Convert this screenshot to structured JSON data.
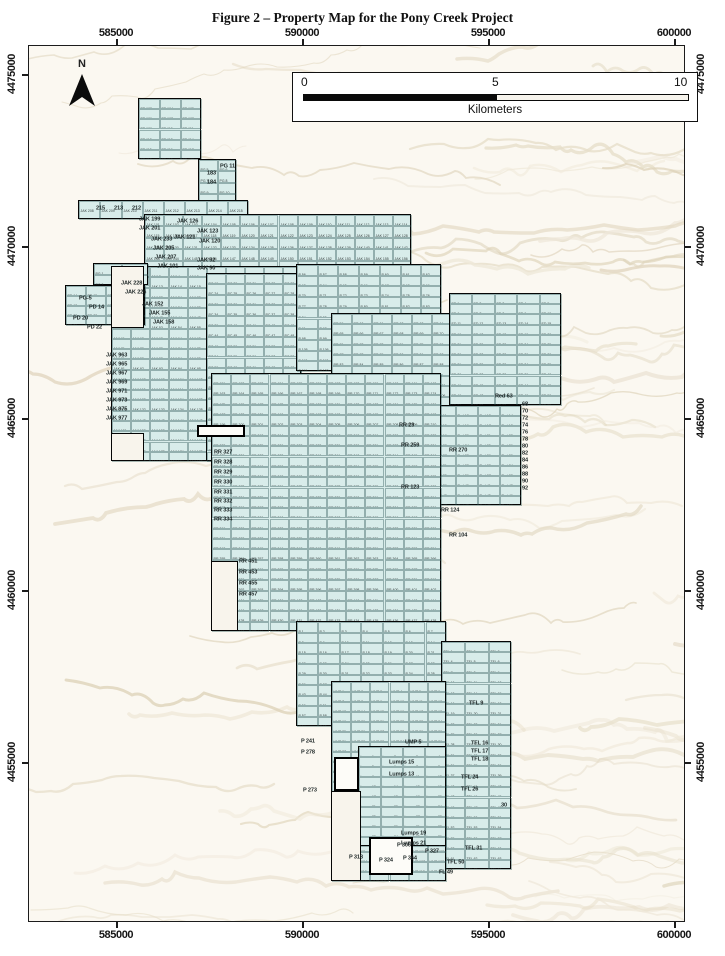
{
  "figure_title": "Figure 2 – Property Map for the Pony Creek Project",
  "north_label": "N",
  "scale_bar": {
    "tick_labels": [
      "0",
      "5",
      "10"
    ],
    "units": "Kilometers"
  },
  "axes": {
    "x_labels": [
      "585000",
      "590000",
      "595000",
      "600000"
    ],
    "x_positions": [
      116,
      302,
      488,
      674
    ],
    "y_labels": [
      "4475000",
      "4470000",
      "4465000",
      "4460000",
      "4455000"
    ],
    "y_positions": [
      74,
      246,
      418,
      590,
      762
    ]
  },
  "colors": {
    "claim_fill": "#d8ecea",
    "claim_outline": "#050505",
    "terrain_base": "#fbf8f1",
    "terrain_ridges": [
      "#e7dfcb",
      "#ddd2b8",
      "#efe8d9",
      "#e2d8c2"
    ]
  },
  "claims": {
    "group_prefixes": [
      "PB",
      "JAK",
      "PC",
      "RR",
      "ED",
      "Red",
      "P",
      "PG",
      "PD",
      "UMP",
      "TFL",
      "Lumps"
    ],
    "blocks": [
      {
        "id": "pb-top",
        "prefix": "PB",
        "start": 103,
        "x": 137,
        "y": 97,
        "w": 63,
        "h": 61
      },
      {
        "id": "pg-neck",
        "prefix": "PG",
        "start": 5,
        "x": 197,
        "y": 158,
        "w": 38,
        "h": 57
      },
      {
        "id": "west-arm",
        "prefix": "JAK",
        "start": 208,
        "x": 77,
        "y": 199,
        "w": 170,
        "h": 19
      },
      {
        "id": "jak-band",
        "prefix": "JAK",
        "start": 101,
        "x": 143,
        "y": 213,
        "w": 267,
        "h": 57
      },
      {
        "id": "jak-main",
        "prefix": "JAK",
        "start": 1,
        "x": 110,
        "y": 265,
        "w": 190,
        "h": 195
      },
      {
        "id": "pc-columns",
        "prefix": "PC",
        "start": 19,
        "x": 205,
        "y": 272,
        "w": 95,
        "h": 188
      },
      {
        "id": "p-upper",
        "prefix": "P",
        "start": 56,
        "x": 295,
        "y": 263,
        "w": 145,
        "h": 107
      },
      {
        "id": "rr-east",
        "prefix": "RR",
        "start": 59,
        "x": 330,
        "y": 312,
        "w": 120,
        "h": 93
      },
      {
        "id": "ed-block",
        "prefix": "ED",
        "start": 1,
        "x": 448,
        "y": 292,
        "w": 112,
        "h": 112
      },
      {
        "id": "red-strip",
        "prefix": "Red",
        "start": 11,
        "x": 432,
        "y": 404,
        "w": 88,
        "h": 100
      },
      {
        "id": "rr-main",
        "prefix": "RR",
        "start": 151,
        "x": 210,
        "y": 372,
        "w": 230,
        "h": 258
      },
      {
        "id": "p-block",
        "prefix": "P",
        "start": 1,
        "x": 295,
        "y": 620,
        "w": 150,
        "h": 105
      },
      {
        "id": "tfl-column",
        "prefix": "TFL",
        "start": 1,
        "x": 440,
        "y": 640,
        "w": 70,
        "h": 228
      },
      {
        "id": "ump-block",
        "prefix": "UMP",
        "start": 1,
        "x": 330,
        "y": 680,
        "w": 115,
        "h": 200
      },
      {
        "id": "lumps-block",
        "prefix": "Lumps",
        "start": 1,
        "x": 357,
        "y": 745,
        "w": 88,
        "h": 100
      },
      {
        "id": "pg-west",
        "prefix": "PG",
        "start": 1,
        "x": 92,
        "y": 262,
        "w": 55,
        "h": 22
      },
      {
        "id": "pd-west",
        "prefix": "PD",
        "start": 14,
        "x": 64,
        "y": 284,
        "w": 80,
        "h": 40
      }
    ],
    "notches": [
      {
        "x": 110,
        "y": 265,
        "w": 33,
        "h": 62
      },
      {
        "x": 110,
        "y": 432,
        "w": 33,
        "h": 28
      },
      {
        "x": 210,
        "y": 560,
        "w": 27,
        "h": 70
      },
      {
        "x": 330,
        "y": 790,
        "w": 30,
        "h": 90
      }
    ],
    "holes": [
      {
        "x": 196,
        "y": 424,
        "w": 48,
        "h": 12
      },
      {
        "x": 333,
        "y": 756,
        "w": 25,
        "h": 34
      },
      {
        "x": 368,
        "y": 836,
        "w": 44,
        "h": 38
      }
    ],
    "annotations": [
      {
        "text": "215",
        "x": 95,
        "y": 203
      },
      {
        "text": "213",
        "x": 113,
        "y": 203
      },
      {
        "text": "212",
        "x": 131,
        "y": 203
      },
      {
        "text": "JAK 199",
        "x": 138,
        "y": 214
      },
      {
        "text": "JAK 201",
        "x": 138,
        "y": 223
      },
      {
        "text": "JAK 233",
        "x": 150,
        "y": 234
      },
      {
        "text": "JAK 205",
        "x": 152,
        "y": 243
      },
      {
        "text": "JAK 207",
        "x": 154,
        "y": 252
      },
      {
        "text": "JAK 101",
        "x": 156,
        "y": 261
      },
      {
        "text": "JAK 126",
        "x": 176,
        "y": 216
      },
      {
        "text": "JAK 123",
        "x": 196,
        "y": 226
      },
      {
        "text": "JAK 121",
        "x": 173,
        "y": 232
      },
      {
        "text": "JAK 120",
        "x": 198,
        "y": 236
      },
      {
        "text": "JAK 92",
        "x": 196,
        "y": 255
      },
      {
        "text": "JAK 90",
        "x": 196,
        "y": 263
      },
      {
        "text": "183",
        "x": 206,
        "y": 168
      },
      {
        "text": "184",
        "x": 206,
        "y": 177
      },
      {
        "text": "PG 11",
        "x": 219,
        "y": 161
      },
      {
        "text": "JAK 228",
        "x": 120,
        "y": 278
      },
      {
        "text": "JAK 226",
        "x": 124,
        "y": 287
      },
      {
        "text": "JAK 152",
        "x": 141,
        "y": 299
      },
      {
        "text": "JAK 155",
        "x": 148,
        "y": 308
      },
      {
        "text": "JAK 158",
        "x": 152,
        "y": 317
      },
      {
        "text": "PG-5",
        "x": 78,
        "y": 293
      },
      {
        "text": "PD 14",
        "x": 88,
        "y": 302
      },
      {
        "text": "PD 20",
        "x": 72,
        "y": 313
      },
      {
        "text": "PD 22",
        "x": 86,
        "y": 322
      },
      {
        "text": "JAK 963",
        "x": 105,
        "y": 350
      },
      {
        "text": "JAK 965",
        "x": 105,
        "y": 359
      },
      {
        "text": "JAK 967",
        "x": 105,
        "y": 368
      },
      {
        "text": "JAK 969",
        "x": 105,
        "y": 377
      },
      {
        "text": "JAK 971",
        "x": 105,
        "y": 386
      },
      {
        "text": "JAK 973",
        "x": 105,
        "y": 395
      },
      {
        "text": "JAK 975",
        "x": 105,
        "y": 404
      },
      {
        "text": "JAK 977",
        "x": 105,
        "y": 413
      },
      {
        "text": "RR 327",
        "x": 213,
        "y": 447
      },
      {
        "text": "RR 328",
        "x": 213,
        "y": 457
      },
      {
        "text": "RR 329",
        "x": 213,
        "y": 467
      },
      {
        "text": "RR 330",
        "x": 213,
        "y": 477
      },
      {
        "text": "RR 331",
        "x": 213,
        "y": 487
      },
      {
        "text": "RR 332",
        "x": 213,
        "y": 496
      },
      {
        "text": "RR 333",
        "x": 213,
        "y": 505
      },
      {
        "text": "RR 334",
        "x": 213,
        "y": 514
      },
      {
        "text": "RR 451",
        "x": 238,
        "y": 556
      },
      {
        "text": "RR 453",
        "x": 238,
        "y": 567
      },
      {
        "text": "RR 455",
        "x": 238,
        "y": 578
      },
      {
        "text": "RR 457",
        "x": 238,
        "y": 589
      },
      {
        "text": "RR 29",
        "x": 398,
        "y": 420
      },
      {
        "text": "RR 259",
        "x": 400,
        "y": 440
      },
      {
        "text": "RR 270",
        "x": 448,
        "y": 445
      },
      {
        "text": "RR 123",
        "x": 400,
        "y": 482
      },
      {
        "text": "RR 124",
        "x": 440,
        "y": 505
      },
      {
        "text": "RR 104",
        "x": 448,
        "y": 530
      },
      {
        "text": "Red 63",
        "x": 494,
        "y": 391
      },
      {
        "text": "68",
        "x": 521,
        "y": 399
      },
      {
        "text": "70",
        "x": 521,
        "y": 406
      },
      {
        "text": "72",
        "x": 521,
        "y": 413
      },
      {
        "text": "74",
        "x": 521,
        "y": 420
      },
      {
        "text": "76",
        "x": 521,
        "y": 427
      },
      {
        "text": "78",
        "x": 521,
        "y": 434
      },
      {
        "text": "80",
        "x": 521,
        "y": 441
      },
      {
        "text": "82",
        "x": 521,
        "y": 448
      },
      {
        "text": "84",
        "x": 521,
        "y": 455
      },
      {
        "text": "86",
        "x": 521,
        "y": 462
      },
      {
        "text": "88",
        "x": 521,
        "y": 469
      },
      {
        "text": "90",
        "x": 521,
        "y": 476
      },
      {
        "text": "92",
        "x": 521,
        "y": 483
      },
      {
        "text": "P 241",
        "x": 300,
        "y": 736
      },
      {
        "text": "P 278",
        "x": 300,
        "y": 747
      },
      {
        "text": "P 273",
        "x": 302,
        "y": 785
      },
      {
        "text": "Lumps 15",
        "x": 388,
        "y": 757
      },
      {
        "text": "Lumps 13",
        "x": 388,
        "y": 769
      },
      {
        "text": "Lumps 19",
        "x": 400,
        "y": 828
      },
      {
        "text": "Lumps 21",
        "x": 400,
        "y": 838
      },
      {
        "text": "UMP 5",
        "x": 404,
        "y": 737
      },
      {
        "text": "TFL 9",
        "x": 468,
        "y": 698
      },
      {
        "text": "TFL 16",
        "x": 470,
        "y": 738
      },
      {
        "text": "TFL 17",
        "x": 470,
        "y": 746
      },
      {
        "text": "TFL 18",
        "x": 470,
        "y": 754
      },
      {
        "text": "TFL 24",
        "x": 460,
        "y": 772
      },
      {
        "text": "TFL 26",
        "x": 460,
        "y": 784
      },
      {
        "text": "30",
        "x": 500,
        "y": 800
      },
      {
        "text": "TFL 31",
        "x": 464,
        "y": 843
      },
      {
        "text": "TFL 50",
        "x": 446,
        "y": 857
      },
      {
        "text": "FL 49",
        "x": 438,
        "y": 867
      },
      {
        "text": "P 306",
        "x": 396,
        "y": 840
      },
      {
        "text": "P 327",
        "x": 424,
        "y": 846
      },
      {
        "text": "P 364",
        "x": 402,
        "y": 853
      },
      {
        "text": "P 324",
        "x": 378,
        "y": 855
      },
      {
        "text": "P 318",
        "x": 348,
        "y": 852
      }
    ]
  }
}
